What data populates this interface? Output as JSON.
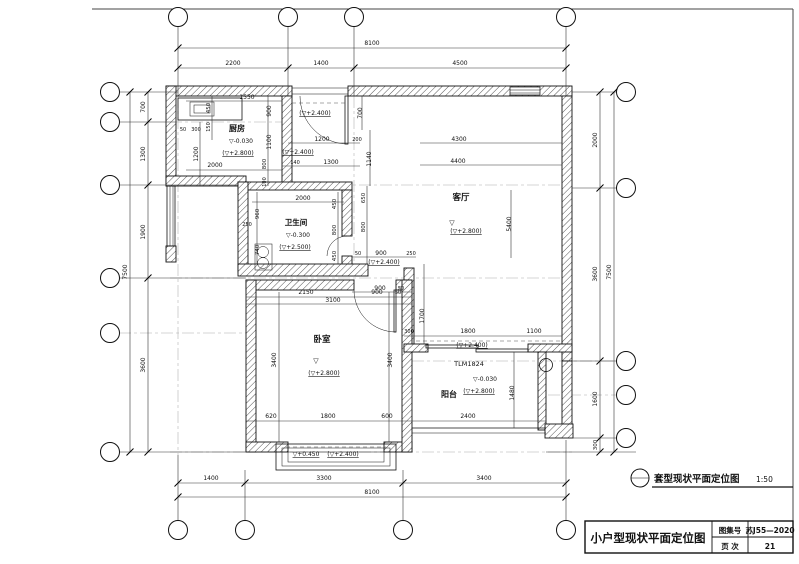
{
  "sheet": {
    "caption_title": "套型现状平面定位图",
    "caption_scale": "1:50",
    "title_block": {
      "drawing_title": "小户型现状平面定位图",
      "atlas_label": "图集号",
      "atlas_value": "苏J55—2020",
      "page_label": "页 次",
      "page_value": "21"
    }
  },
  "plan": {
    "rooms": [
      "厨房",
      "卫生间",
      "客厅",
      "卧室",
      "阳台"
    ],
    "door_type_label": "TLM1824",
    "dimension_chains": {
      "top": {
        "overall": "8100",
        "segments": [
          "2200",
          "1400",
          "4500"
        ]
      },
      "bottom": {
        "overall": "8100",
        "segments": [
          "1400",
          "3300",
          "3400"
        ]
      },
      "left": {
        "overall": "7500",
        "segments": [
          "700",
          "1300",
          "1900",
          "3600"
        ]
      },
      "right": {
        "overall": "7500",
        "segments": [
          "2000",
          "3600",
          "1600",
          "300"
        ]
      }
    },
    "labels": [
      {
        "t": "8100",
        "x": 372,
        "y": 45
      },
      {
        "t": "2200",
        "x": 233,
        "y": 65
      },
      {
        "t": "1400",
        "x": 321,
        "y": 65
      },
      {
        "t": "4500",
        "x": 460,
        "y": 65
      },
      {
        "t": "1400",
        "x": 211,
        "y": 480
      },
      {
        "t": "3300",
        "x": 324,
        "y": 480
      },
      {
        "t": "3400",
        "x": 484,
        "y": 480
      },
      {
        "t": "8100",
        "x": 372,
        "y": 494
      },
      {
        "t": "700",
        "x": 145,
        "y": 107,
        "r": -90
      },
      {
        "t": "1300",
        "x": 145,
        "y": 154,
        "r": -90
      },
      {
        "t": "1900",
        "x": 145,
        "y": 232,
        "r": -90
      },
      {
        "t": "3600",
        "x": 145,
        "y": 365,
        "r": -90
      },
      {
        "t": "7500",
        "x": 127,
        "y": 272,
        "r": -90
      },
      {
        "t": "2000",
        "x": 597,
        "y": 140,
        "r": -90
      },
      {
        "t": "3600",
        "x": 597,
        "y": 274,
        "r": -90
      },
      {
        "t": "1600",
        "x": 597,
        "y": 399,
        "r": -90
      },
      {
        "t": "300",
        "x": 597,
        "y": 445,
        "r": -90,
        "fs": 5.5
      },
      {
        "t": "7500",
        "x": 611,
        "y": 272,
        "r": -90
      },
      {
        "t": "1550",
        "x": 247,
        "y": 99
      },
      {
        "t": "450",
        "x": 210,
        "y": 108,
        "r": -90,
        "fs": 5.5
      },
      {
        "t": "900",
        "x": 271,
        "y": 111,
        "r": -90
      },
      {
        "t": "150",
        "x": 210,
        "y": 127,
        "r": -90,
        "fs": 5
      },
      {
        "t": "50",
        "x": 183,
        "y": 131,
        "fs": 5
      },
      {
        "t": "300",
        "x": 196,
        "y": 131,
        "fs": 5
      },
      {
        "t": "厨房",
        "x": 237,
        "y": 131,
        "b": 1,
        "fs": 8
      },
      {
        "t": "▽-0.030",
        "x": 241,
        "y": 143,
        "fs": 6
      },
      {
        "t": "(▽+2.800)",
        "x": 238,
        "y": 155,
        "u": 1,
        "fs": 6
      },
      {
        "t": "1200",
        "x": 198,
        "y": 154,
        "r": -90
      },
      {
        "t": "2000",
        "x": 215,
        "y": 167
      },
      {
        "t": "1100",
        "x": 271,
        "y": 142,
        "r": -90
      },
      {
        "t": "800",
        "x": 266,
        "y": 164,
        "r": -90,
        "fs": 5.5
      },
      {
        "t": "100",
        "x": 266,
        "y": 182,
        "r": -90,
        "fs": 5
      },
      {
        "t": "140",
        "x": 295,
        "y": 164,
        "fs": 5
      },
      {
        "t": "1300",
        "x": 331,
        "y": 164
      },
      {
        "t": "1200",
        "x": 322,
        "y": 141
      },
      {
        "t": "200",
        "x": 357,
        "y": 141,
        "fs": 5
      },
      {
        "t": "1140",
        "x": 371,
        "y": 159,
        "r": -90
      },
      {
        "t": "700",
        "x": 362,
        "y": 113,
        "r": -90
      },
      {
        "t": "(▽+2.400)",
        "x": 315,
        "y": 115,
        "u": 1,
        "fs": 6
      },
      {
        "t": "(▽+2.400)",
        "x": 298,
        "y": 154,
        "u": 1,
        "fs": 6
      },
      {
        "t": "4300",
        "x": 459,
        "y": 141
      },
      {
        "t": "4400",
        "x": 458,
        "y": 163
      },
      {
        "t": "客厅",
        "x": 461,
        "y": 200,
        "b": 1,
        "fs": 8.5
      },
      {
        "t": "▽",
        "x": 452,
        "y": 225,
        "fs": 7
      },
      {
        "t": "(▽+2.800)",
        "x": 466,
        "y": 233,
        "u": 1,
        "fs": 6
      },
      {
        "t": "5400",
        "x": 511,
        "y": 224,
        "r": -90
      },
      {
        "t": "2000",
        "x": 303,
        "y": 200
      },
      {
        "t": "450",
        "x": 336,
        "y": 204,
        "r": -90,
        "fs": 5.5
      },
      {
        "t": "650",
        "x": 365,
        "y": 198,
        "r": -90,
        "fs": 5.5
      },
      {
        "t": "960",
        "x": 259,
        "y": 214,
        "r": -90,
        "fs": 5.5
      },
      {
        "t": "250",
        "x": 247,
        "y": 226,
        "fs": 5
      },
      {
        "t": "卫生间",
        "x": 296,
        "y": 225,
        "b": 1,
        "fs": 7.5
      },
      {
        "t": "▽-0.300",
        "x": 298,
        "y": 237,
        "fs": 6
      },
      {
        "t": "(▽+2.500)",
        "x": 295,
        "y": 249,
        "u": 1,
        "fs": 6
      },
      {
        "t": "740",
        "x": 259,
        "y": 250,
        "r": -90,
        "fs": 5.5
      },
      {
        "t": "800",
        "x": 336,
        "y": 230,
        "r": -90,
        "fs": 5.5
      },
      {
        "t": "450",
        "x": 336,
        "y": 256,
        "r": -90,
        "fs": 5.5
      },
      {
        "t": "800",
        "x": 365,
        "y": 227,
        "r": -90,
        "fs": 5.5
      },
      {
        "t": "50",
        "x": 358,
        "y": 255,
        "fs": 5
      },
      {
        "t": "900",
        "x": 381,
        "y": 255
      },
      {
        "t": "250",
        "x": 411,
        "y": 255,
        "fs": 5
      },
      {
        "t": "(▽+2.400)",
        "x": 384,
        "y": 264,
        "u": 1,
        "fs": 6
      },
      {
        "t": "900",
        "x": 380,
        "y": 290
      },
      {
        "t": "50",
        "x": 401,
        "y": 290,
        "fs": 5
      },
      {
        "t": "2150",
        "x": 306,
        "y": 294
      },
      {
        "t": "900",
        "x": 377,
        "y": 294
      },
      {
        "t": "50",
        "x": 398,
        "y": 294,
        "fs": 5
      },
      {
        "t": "3100",
        "x": 333,
        "y": 302
      },
      {
        "t": "3400",
        "x": 276,
        "y": 360,
        "r": -90
      },
      {
        "t": "3400",
        "x": 392,
        "y": 360,
        "r": -90
      },
      {
        "t": "卧室",
        "x": 322,
        "y": 342,
        "b": 1,
        "fs": 8.5
      },
      {
        "t": "▽",
        "x": 316,
        "y": 363,
        "fs": 7
      },
      {
        "t": "(▽+2.800)",
        "x": 324,
        "y": 375,
        "u": 1,
        "fs": 6
      },
      {
        "t": "1700",
        "x": 424,
        "y": 316,
        "r": -90
      },
      {
        "t": "300",
        "x": 409,
        "y": 333,
        "fs": 5
      },
      {
        "t": "1800",
        "x": 468,
        "y": 333
      },
      {
        "t": "1100",
        "x": 534,
        "y": 333
      },
      {
        "t": "(▽+2.400)",
        "x": 472,
        "y": 347,
        "u": 1,
        "fs": 6
      },
      {
        "t": "TLM1824",
        "x": 469,
        "y": 366,
        "fs": 6.5
      },
      {
        "t": "▽-0.030",
        "x": 485,
        "y": 381,
        "fs": 6
      },
      {
        "t": "(▽+2.800)",
        "x": 479,
        "y": 393,
        "u": 1,
        "fs": 6
      },
      {
        "t": "阳台",
        "x": 449,
        "y": 397,
        "b": 1,
        "fs": 8
      },
      {
        "t": "1480",
        "x": 514,
        "y": 393,
        "r": -90
      },
      {
        "t": "2400",
        "x": 468,
        "y": 418
      },
      {
        "t": "620",
        "x": 271,
        "y": 418
      },
      {
        "t": "1800",
        "x": 328,
        "y": 418
      },
      {
        "t": "600",
        "x": 387,
        "y": 418
      },
      {
        "t": "▽+0.450",
        "x": 306,
        "y": 456,
        "u": 1,
        "fs": 6
      },
      {
        "t": "(▽+2.400)",
        "x": 343,
        "y": 456,
        "u": 1,
        "fs": 6
      }
    ]
  }
}
